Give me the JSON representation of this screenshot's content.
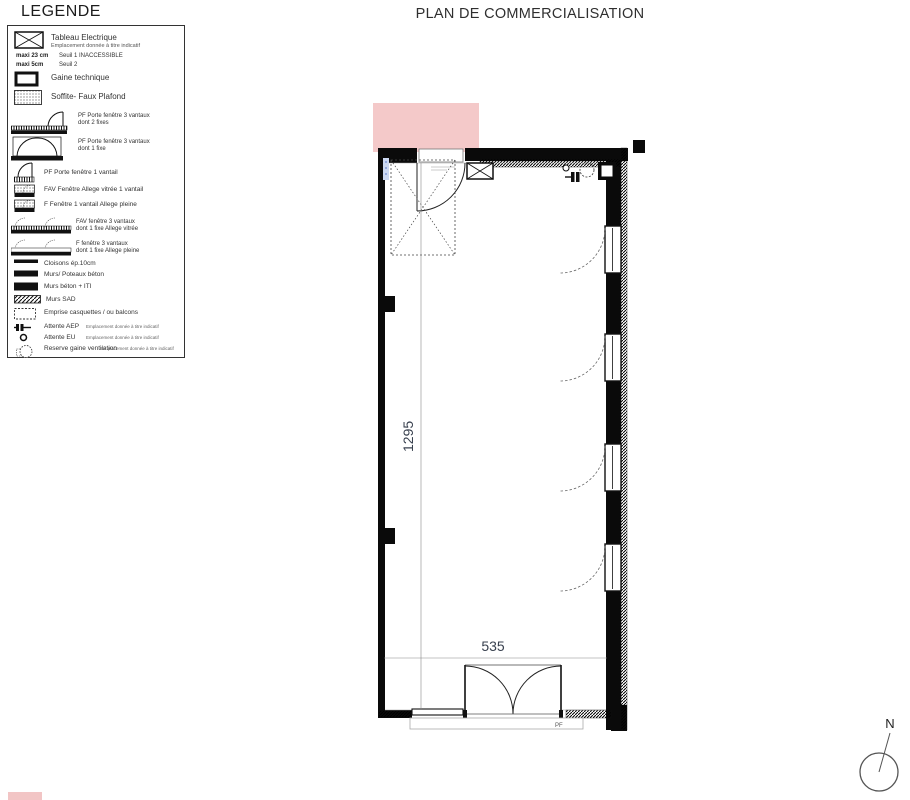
{
  "plan_title": "PLAN DE COMMERCIALISATION",
  "legend": {
    "title": "LEGENDE",
    "items": [
      {
        "label": "Tableau Electrique",
        "sub": "Emplacement donnée à titre indicatif"
      },
      {
        "bold1": "maxi 23 cm",
        "bold2": "maxi 5cm",
        "text1": "Seuil 1 INACCESSIBLE",
        "text2": "Seuil 2"
      },
      {
        "label": "Gaine technique"
      },
      {
        "label": "Soffite- Faux Plafond"
      },
      {
        "label": "PF Porte fenêtre 3 vantaux",
        "label2": "dont 2 fixes"
      },
      {
        "label": "PF Porte fenêtre 3 vantaux",
        "label2": "dont 1 fixe"
      },
      {
        "label": "PF Porte fenêtre 1 vantail"
      },
      {
        "label": "FAV Fenêtre Allege vitrée 1 vantail"
      },
      {
        "label": "F Fenêtre 1 vantail Allege pleine"
      },
      {
        "label": "FAV fenêtre 3 vantaux",
        "label2": "dont 1 fixe Allege vitrée"
      },
      {
        "label": "F fenêtre 3 vantaux",
        "label2": "dont 1 fixe Allege pleine"
      },
      {
        "label": "Cloisons ép.10cm"
      },
      {
        "label": "Murs/ Poteaux béton"
      },
      {
        "label": "Murs béton + ITI"
      },
      {
        "label": "Murs SAD"
      },
      {
        "label": "Emprise casquettes / ou balcons"
      },
      {
        "label": "Attente AEP",
        "note": "Emplacement donnée à titre indicatif"
      },
      {
        "label": "Attente EU",
        "note": "Emplacement donnée à titre indicatif"
      },
      {
        "label": "Reserve gaine ventilation",
        "note": "Emplacement donnée à titre indicatif"
      }
    ]
  },
  "plan": {
    "dim_vertical": "1295",
    "dim_horizontal": "535",
    "door_label": "PF"
  },
  "compass": {
    "label": "N"
  },
  "colors": {
    "pink_zone": "#f4c9c9",
    "pink_bar": "#f2c5c5",
    "dim_text": "#39414f",
    "wall": "#0a0a0a"
  }
}
